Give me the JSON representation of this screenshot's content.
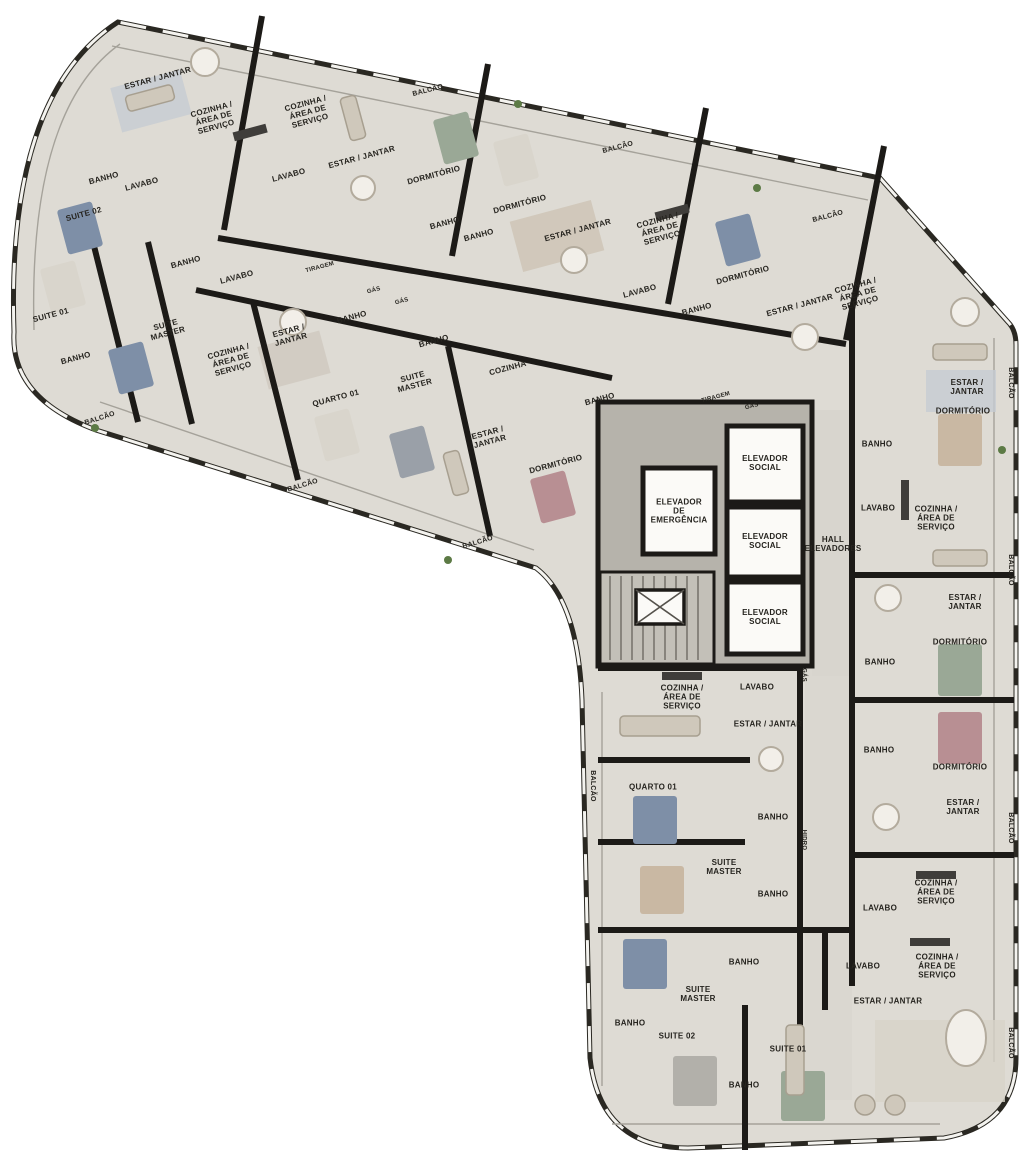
{
  "meta": {
    "kind": "residential floor plan",
    "language": "pt-BR"
  },
  "palette": {
    "plate": "#dedbd4",
    "wall": "#1c1a17",
    "core": "#b6b3ab",
    "hall": "#d8d5ce",
    "bed-blue": "#7e8fa7",
    "bed-green": "#9aa896",
    "bed-rose": "#b88f93",
    "bed-tan": "#c9b8a3",
    "plant": "#5c7a45",
    "text": "#26241f"
  },
  "plan": {
    "labels": [
      {
        "t": "ESTAR / JANTAR",
        "x": 158,
        "y": 79,
        "r": -15
      },
      {
        "t": "COZINHA /\nÁREA DE\nSERVIÇO",
        "x": 214,
        "y": 119,
        "r": -15
      },
      {
        "t": "BANHO",
        "x": 104,
        "y": 179,
        "r": -15
      },
      {
        "t": "LAVABO",
        "x": 142,
        "y": 185,
        "r": -15
      },
      {
        "t": "SUITE 02",
        "x": 84,
        "y": 215,
        "r": -15
      },
      {
        "t": "SUITE 01",
        "x": 51,
        "y": 316,
        "r": -15
      },
      {
        "t": "BANHO",
        "x": 76,
        "y": 359,
        "r": -15
      },
      {
        "t": "SUITE\nMASTER",
        "x": 167,
        "y": 330,
        "r": -15
      },
      {
        "t": "BANHO",
        "x": 186,
        "y": 263,
        "r": -15
      },
      {
        "t": "LAVABO",
        "x": 237,
        "y": 278,
        "r": -15
      },
      {
        "t": "BALCÃO",
        "x": 100,
        "y": 419,
        "r": -18,
        "s": 7
      },
      {
        "t": "COZINHA /\nÁREA DE\nSERVIÇO",
        "x": 308,
        "y": 113,
        "r": -15
      },
      {
        "t": "LAVABO",
        "x": 289,
        "y": 176,
        "r": -15
      },
      {
        "t": "ESTAR / JANTAR",
        "x": 362,
        "y": 158,
        "r": -15
      },
      {
        "t": "DORMITÓRIO",
        "x": 434,
        "y": 176,
        "r": -15
      },
      {
        "t": "BALCÃO",
        "x": 428,
        "y": 91,
        "r": -15,
        "s": 7
      },
      {
        "t": "BANHO",
        "x": 445,
        "y": 224,
        "r": -15
      },
      {
        "t": "BANHO",
        "x": 479,
        "y": 236,
        "r": -15
      },
      {
        "t": "DORMITÓRIO",
        "x": 520,
        "y": 205,
        "r": -15
      },
      {
        "t": "ESTAR / JANTAR",
        "x": 578,
        "y": 231,
        "r": -15
      },
      {
        "t": "BALCÃO",
        "x": 618,
        "y": 148,
        "r": -15,
        "s": 7
      },
      {
        "t": "COZINHA /\nÁREA DE\nSERVIÇO",
        "x": 660,
        "y": 230,
        "r": -15
      },
      {
        "t": "LAVABO",
        "x": 640,
        "y": 292,
        "r": -15
      },
      {
        "t": "BANHO",
        "x": 697,
        "y": 310,
        "r": -15
      },
      {
        "t": "DORMITÓRIO",
        "x": 743,
        "y": 276,
        "r": -15
      },
      {
        "t": "ESTAR / JANTAR",
        "x": 800,
        "y": 306,
        "r": -15
      },
      {
        "t": "BALCÃO",
        "x": 828,
        "y": 217,
        "r": -15,
        "s": 7
      },
      {
        "t": "COZINHA /\nÁREA DE\nSERVIÇO",
        "x": 858,
        "y": 295,
        "r": -15
      },
      {
        "t": "ESTAR /\nJANTAR",
        "x": 290,
        "y": 336,
        "r": -15
      },
      {
        "t": "COZINHA /\nÁREA DE\nSERVIÇO",
        "x": 231,
        "y": 361,
        "r": -15
      },
      {
        "t": "BANHO",
        "x": 352,
        "y": 318,
        "r": -15
      },
      {
        "t": "QUARTO 01",
        "x": 336,
        "y": 399,
        "r": -15
      },
      {
        "t": "BANHO",
        "x": 434,
        "y": 342,
        "r": -15
      },
      {
        "t": "SUITE\nMASTER",
        "x": 414,
        "y": 382,
        "r": -15
      },
      {
        "t": "COZINHA",
        "x": 508,
        "y": 369,
        "r": -15
      },
      {
        "t": "BANHO",
        "x": 600,
        "y": 400,
        "r": -15
      },
      {
        "t": "ESTAR /\nJANTAR",
        "x": 489,
        "y": 438,
        "r": -15
      },
      {
        "t": "DORMITÓRIO",
        "x": 556,
        "y": 465,
        "r": -15
      },
      {
        "t": "BALCÃO",
        "x": 303,
        "y": 486,
        "r": -17,
        "s": 7
      },
      {
        "t": "BALCÃO",
        "x": 478,
        "y": 543,
        "r": -17,
        "s": 7
      },
      {
        "t": "TIRAGEM",
        "x": 320,
        "y": 268,
        "r": -15,
        "s": 6
      },
      {
        "t": "GÁS",
        "x": 374,
        "y": 291,
        "r": -15,
        "s": 6
      },
      {
        "t": "GÁS",
        "x": 402,
        "y": 302,
        "r": -15,
        "s": 6
      },
      {
        "t": "TIRAGEM",
        "x": 716,
        "y": 398,
        "r": -15,
        "s": 6
      },
      {
        "t": "GÁS",
        "x": 752,
        "y": 407,
        "r": -15,
        "s": 6
      },
      {
        "t": "ELEVADOR\nDE\nEMERGÊNCIA",
        "x": 679,
        "y": 512,
        "r": 0
      },
      {
        "t": "ELEVADOR\nSOCIAL",
        "x": 765,
        "y": 464,
        "r": 0
      },
      {
        "t": "ELEVADOR\nSOCIAL",
        "x": 765,
        "y": 542,
        "r": 0
      },
      {
        "t": "ELEVADOR\nSOCIAL",
        "x": 765,
        "y": 618,
        "r": 0
      },
      {
        "t": "HALL\nELEVADORES",
        "x": 833,
        "y": 545,
        "r": 0
      },
      {
        "t": "ESTAR / JANTAR",
        "x": 967,
        "y": 388,
        "r": 0
      },
      {
        "t": "DORMITÓRIO",
        "x": 963,
        "y": 412,
        "r": 0
      },
      {
        "t": "BALCÃO",
        "x": 1010,
        "y": 383,
        "r": 90,
        "s": 7
      },
      {
        "t": "BANHO",
        "x": 877,
        "y": 445,
        "r": 0
      },
      {
        "t": "LAVABO",
        "x": 878,
        "y": 509,
        "r": 0
      },
      {
        "t": "COZINHA /\nÁREA DE\nSERVIÇO",
        "x": 936,
        "y": 519,
        "r": 0
      },
      {
        "t": "ESTAR / JANTAR",
        "x": 965,
        "y": 603,
        "r": 0
      },
      {
        "t": "DORMITÓRIO",
        "x": 960,
        "y": 643,
        "r": 0
      },
      {
        "t": "BANHO",
        "x": 880,
        "y": 663,
        "r": 0
      },
      {
        "t": "BANHO",
        "x": 879,
        "y": 751,
        "r": 0
      },
      {
        "t": "DORMITÓRIO",
        "x": 960,
        "y": 768,
        "r": 0
      },
      {
        "t": "ESTAR / JANTAR",
        "x": 963,
        "y": 808,
        "r": 0
      },
      {
        "t": "BALCÃO",
        "x": 1010,
        "y": 570,
        "r": 90,
        "s": 7
      },
      {
        "t": "BALCÃO",
        "x": 1010,
        "y": 828,
        "r": 90,
        "s": 7
      },
      {
        "t": "LAVABO",
        "x": 880,
        "y": 909,
        "r": 0
      },
      {
        "t": "COZINHA /\nÁREA DE\nSERVIÇO",
        "x": 936,
        "y": 893,
        "r": 0
      },
      {
        "t": "LAVABO",
        "x": 863,
        "y": 967,
        "r": 0
      },
      {
        "t": "COZINHA /\nÁREA DE\nSERVIÇO",
        "x": 937,
        "y": 967,
        "r": 0
      },
      {
        "t": "ESTAR / JANTAR",
        "x": 888,
        "y": 1002,
        "r": 0
      },
      {
        "t": "BALCÃO",
        "x": 1010,
        "y": 1043,
        "r": 90,
        "s": 7
      },
      {
        "t": "COZINHA /\nÁREA DE\nSERVIÇO",
        "x": 682,
        "y": 698,
        "r": 0
      },
      {
        "t": "LAVABO",
        "x": 757,
        "y": 688,
        "r": 0
      },
      {
        "t": "ESTAR / JANTAR",
        "x": 768,
        "y": 725,
        "r": 0
      },
      {
        "t": "QUARTO 01",
        "x": 653,
        "y": 788,
        "r": 0
      },
      {
        "t": "BANHO",
        "x": 773,
        "y": 818,
        "r": 0
      },
      {
        "t": "SUITE\nMASTER",
        "x": 724,
        "y": 868,
        "r": 0
      },
      {
        "t": "BANHO",
        "x": 773,
        "y": 895,
        "r": 0
      },
      {
        "t": "BALCÃO",
        "x": 592,
        "y": 786,
        "r": 90,
        "s": 7
      },
      {
        "t": "GÁS",
        "x": 803,
        "y": 675,
        "r": 90,
        "s": 6
      },
      {
        "t": "HIDRO",
        "x": 803,
        "y": 840,
        "r": 90,
        "s": 6
      },
      {
        "t": "BANHO",
        "x": 744,
        "y": 963,
        "r": 0
      },
      {
        "t": "SUITE\nMASTER",
        "x": 698,
        "y": 995,
        "r": 0
      },
      {
        "t": "BANHO",
        "x": 630,
        "y": 1024,
        "r": 0
      },
      {
        "t": "SUITE 02",
        "x": 677,
        "y": 1037,
        "r": 0
      },
      {
        "t": "BANHO",
        "x": 744,
        "y": 1086,
        "r": 0
      },
      {
        "t": "SUITE 01",
        "x": 788,
        "y": 1050,
        "r": 0
      }
    ]
  }
}
